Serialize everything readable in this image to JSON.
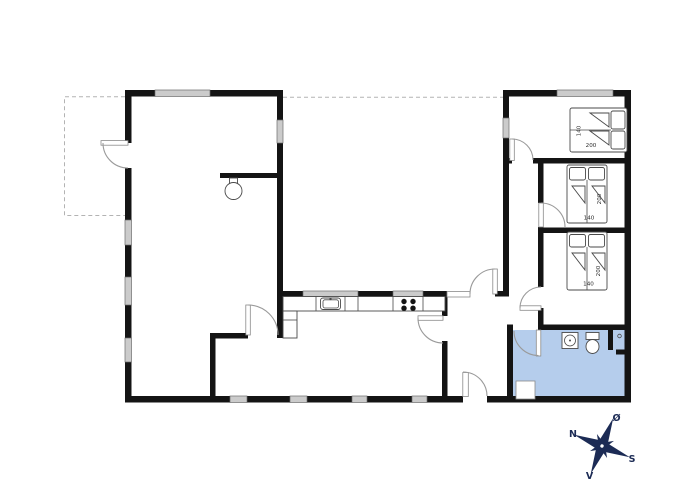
{
  "floorplan": {
    "beds": [
      {
        "width_label": "140",
        "length_label": "200"
      },
      {
        "width_label": "140",
        "length_label": "200"
      },
      {
        "width_label": "140",
        "length_label": "200"
      }
    ],
    "compass": {
      "n": "N",
      "e": "Ø",
      "s": "S",
      "v": "V"
    },
    "colors": {
      "wall": "#141414",
      "bathroom_fill": "#b5cdec",
      "window_fill": "#cbcbcb",
      "door_arc": "#9a9a9a",
      "compass_navy": "#1c2b55"
    }
  }
}
